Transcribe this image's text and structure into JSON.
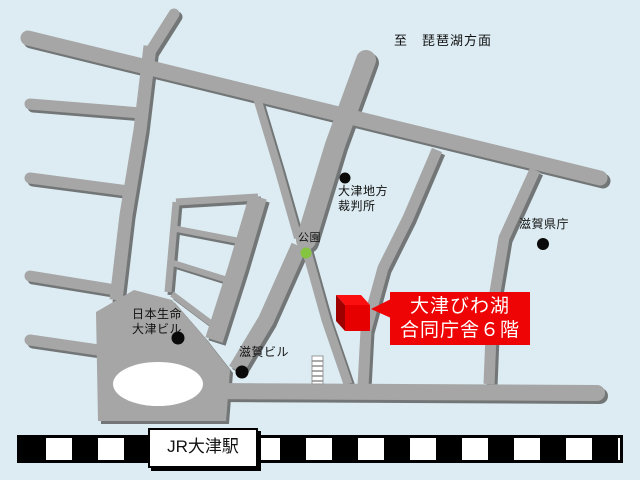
{
  "map": {
    "region": "JR大津駅周辺",
    "colors": {
      "background": "#dcecf2",
      "road": "#a6a6a6",
      "road_shadow": "#606060",
      "accent_red": "#ee0404",
      "park_green": "#85c440",
      "railway": "#000000"
    }
  },
  "direction_sign": {
    "label": "至　琵琶湖方面"
  },
  "destination": {
    "line1": "大津びわ湖",
    "line2": "合同庁舎６階",
    "marker": "red-3d-building-cube"
  },
  "pois": [
    {
      "id": "courthouse",
      "label": "大津地方\n裁判所",
      "marker": "black-dot"
    },
    {
      "id": "prefectural-office",
      "label": "滋賀県庁",
      "marker": "black-dot"
    },
    {
      "id": "park",
      "label": "公園",
      "marker": "green-dot"
    },
    {
      "id": "nippon-life-building",
      "label": "日本生命\n大津ビル",
      "marker": "black-dot"
    },
    {
      "id": "shiga-building",
      "label": "滋賀ビル",
      "marker": "black-dot"
    }
  ],
  "station": {
    "label": "JR大津駅"
  }
}
